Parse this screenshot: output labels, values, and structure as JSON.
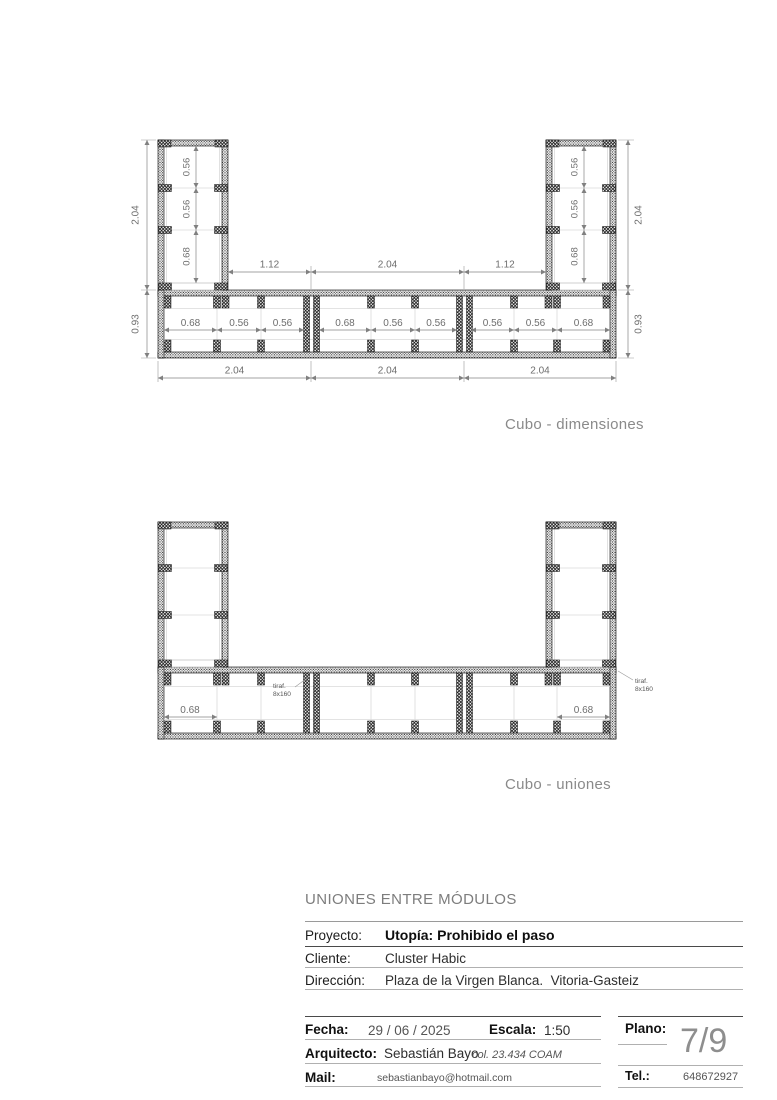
{
  "drawing1": {
    "caption": "Cubo - dimensiones",
    "left_height": "2.04",
    "right_height": "2.04",
    "left_bar_height": "0.93",
    "right_bar_height": "0.93",
    "tower_bays": [
      "0.56",
      "0.56",
      "0.68"
    ],
    "span_dims": [
      "1.12",
      "2.04",
      "1.12"
    ],
    "module1_bays": [
      "0.68",
      "0.56",
      "0.56"
    ],
    "module2_bays": [
      "0.68",
      "0.56",
      "0.56"
    ],
    "module3_bays": [
      "0.56",
      "0.56",
      "0.68"
    ],
    "bottom_dims": [
      "2.04",
      "2.04",
      "2.04"
    ]
  },
  "drawing2": {
    "caption": "Cubo - uniones",
    "left_bay_dim": "0.68",
    "right_bay_dim": "0.68",
    "fastener_left": {
      "line1": "tiraf.",
      "line2": "8x160"
    },
    "fastener_right": {
      "line1": "tiraf.",
      "line2": "8x160"
    }
  },
  "titleblock": {
    "section_title": "UNIONES ENTRE MÓDULOS",
    "proyecto_label": "Proyecto:",
    "proyecto_value": "Utopía: Prohibido el paso",
    "cliente_label": "Cliente:",
    "cliente_value": "Cluster Habic",
    "direccion_label": "Dirección:",
    "direccion_value": "Plaza de la Virgen Blanca.  Vitoria-Gasteiz",
    "fecha_label": "Fecha:",
    "fecha_value": "29 / 06 / 2025",
    "escala_label": "Escala:",
    "escala_value": "1:50",
    "plano_label": "Plano:",
    "plano_value": "7/9",
    "arquitecto_label": "Arquitecto:",
    "arquitecto_value": "Sebastián Bayo",
    "arquitecto_credential": "col. 23.434 COAM",
    "mail_label": "Mail:",
    "mail_value": "sebastianbayo@hotmail.com",
    "tel_label": "Tel.:",
    "tel_value": "648672927"
  },
  "colors": {
    "linework": "#111111",
    "dimension": "#777777",
    "caption": "#8a8a8a",
    "rule_dark": "#4a4a4a",
    "rule_light": "#b0b0b0"
  }
}
